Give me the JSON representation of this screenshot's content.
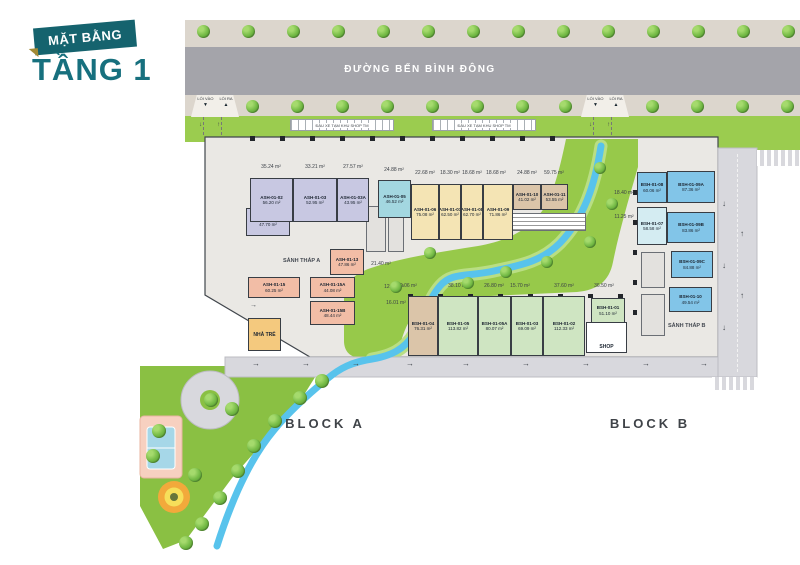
{
  "title": {
    "tag": "MẶT BẰNG",
    "floor": "TẦNG 1"
  },
  "street_name": "ĐƯỜNG BẾN BÌNH ĐÔNG",
  "entrance": {
    "in_label": "LỐI VÀO",
    "out_label": "LỐI RA"
  },
  "parking_label": "ĐẬU XE TẠM KHU SHOP TM",
  "lobby_a": "SẢNH THÁP A",
  "lobby_b": "SẢNH THÁP B",
  "kindergarten": "NHÀ TRẺ",
  "shop_label": "SHOP",
  "block_a": "BLOCK A",
  "block_b": "BLOCK B",
  "units": [
    {
      "id": "ASH-01-01",
      "area": "47.70 m²",
      "color": "purple"
    },
    {
      "id": "ASH-01-02",
      "area": "56.20 m²",
      "color": "purple"
    },
    {
      "id": "ASH-01-03",
      "area": "52.95 m²",
      "color": "purple"
    },
    {
      "id": "ASH-01-03A",
      "area": "43.95 m²",
      "color": "purple"
    },
    {
      "id": "ASH-01-05",
      "area": "46.52 m²",
      "color": "teal"
    },
    {
      "id": "ASH-01-06",
      "area": "75.08 m²",
      "color": "yellow"
    },
    {
      "id": "ASH-01-07",
      "area": "62.50 m²",
      "color": "yellow"
    },
    {
      "id": "ASH-01-08",
      "area": "62.70 m²",
      "color": "yellow"
    },
    {
      "id": "ASH-01-09",
      "area": "71.86 m²",
      "color": "yellow"
    },
    {
      "id": "ASH-01-10",
      "area": "41.02 m²",
      "color": "tan"
    },
    {
      "id": "ASH-01-11",
      "area": "53.55 m²",
      "color": "tan"
    },
    {
      "id": "ASH-01-13",
      "area": "47.86 m²",
      "color": "pink"
    },
    {
      "id": "ASH-01-15",
      "area": "60.25 m²",
      "color": "pink"
    },
    {
      "id": "ASH-01-15A",
      "area": "44.08 m²",
      "color": "pink"
    },
    {
      "id": "ASH-01-15B",
      "area": "48.44 m²",
      "color": "pink"
    },
    {
      "id": "BSH-01-04",
      "area": "76.31 m²",
      "color": "tan"
    },
    {
      "id": "BSH-01-05",
      "area": "113.82 m²",
      "color": "green"
    },
    {
      "id": "BSH-01-05A",
      "area": "80.07 m²",
      "color": "green"
    },
    {
      "id": "BSH-01-03",
      "area": "69.09 m²",
      "color": "green"
    },
    {
      "id": "BSH-01-02",
      "area": "112.33 m²",
      "color": "green"
    },
    {
      "id": "BSH-01-01",
      "area": "51.10 m²",
      "color": "green"
    },
    {
      "id": "BSH-01-08",
      "area": "60.06 m²",
      "color": "blue"
    },
    {
      "id": "BSH-01-09A",
      "area": "87.36 m²",
      "color": "blue"
    },
    {
      "id": "BSH-01-07",
      "area": "58.58 m²",
      "color": "lightteal"
    },
    {
      "id": "BSH-01-09B",
      "area": "83.86 m²",
      "color": "blue"
    },
    {
      "id": "BSH-01-09C",
      "area": "84.88 m²",
      "color": "blue"
    },
    {
      "id": "BSH-01-10",
      "area": "49.54 m²",
      "color": "blue"
    }
  ],
  "outside_areas": [
    "35.24 m²",
    "33.21 m²",
    "27.57 m²",
    "24.88 m²",
    "22.68 m²",
    "18.30 m²",
    "18.68 m²",
    "18.68 m²",
    "24.88 m²",
    "59.75 m²",
    "21.40 m²",
    "12.91 m²",
    "16.01 m²",
    "20.06 m²",
    "38.10 m²",
    "26.80 m²",
    "15.70 m²",
    "37.60 m²",
    "36.50 m²",
    "18.40 m²",
    "11.25 m²"
  ],
  "colors": {
    "accent_teal": "#15636e",
    "title_text": "#17707e",
    "banner_gold": "#a28a35",
    "asphalt": "#a4a4aa",
    "pavement": "#dcd6cd",
    "grass": "#9bcc4f",
    "park": "#8ac043",
    "stream": "#58c3ec",
    "slab": "#eae8e4",
    "local_road": "#d8d8dd",
    "units": {
      "purple": "#c8c8e2",
      "teal": "#a3d7e0",
      "yellow": "#f4e4b4",
      "tan": "#dbc5a9",
      "pink": "#f2bda6",
      "green": "#cfe5c2",
      "blue": "#82c5e8",
      "lightteal": "#d4ecf2",
      "orange": "#f4c97e"
    }
  }
}
